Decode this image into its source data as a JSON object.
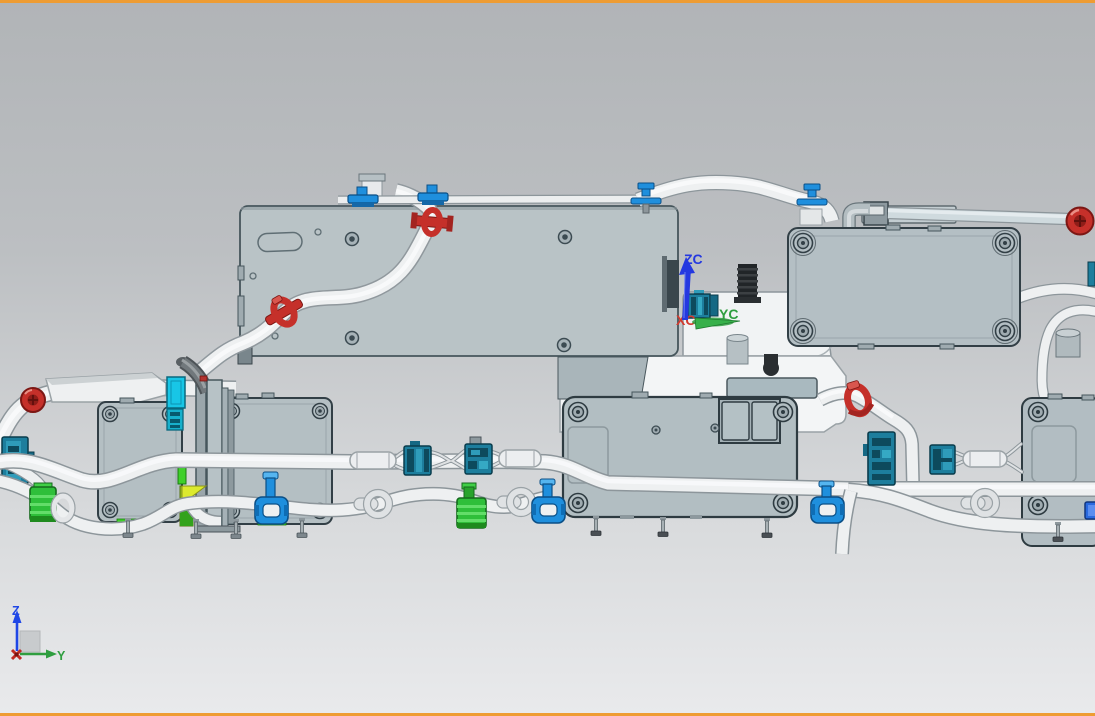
{
  "viewport": {
    "width": 1095,
    "height": 716,
    "background_top": "#b1b4b7",
    "background_bottom": "#e9eaec",
    "frame_color": "#ee9c33"
  },
  "wcs_marker": {
    "z_label": "ZC",
    "y_label": "YC",
    "x_label": "XC",
    "z_color": "#2438e0",
    "y_color": "#2f9e3f",
    "x_color": "#d23a2e"
  },
  "view_triad": {
    "z_label": "Z",
    "y_label": "Y",
    "z_color": "#1f47e6",
    "y_color": "#2f9e3f",
    "origin_color": "#c02a24"
  },
  "palette": {
    "module_fill": "#b4bfc4",
    "module_outline": "#323f46",
    "tube_fill": "#eef0f1",
    "tube_outline": "#8d969b",
    "coolant_tube": "#cfdade",
    "clamp_red": "#c5302a",
    "clip_blue": "#1f8fdd",
    "connector_teal": "#1d7e9d",
    "connector_green": "#2fbf3a",
    "accent_cyan": "#18c6e6",
    "accent_yellow": "#dcea2e",
    "antenna_black": "#212528"
  },
  "components": [
    "mounting-plate",
    "ecu-module-top-right",
    "ecu-module-center",
    "ecu-module-left-a",
    "ecu-module-left-b",
    "ecu-module-right-partial",
    "center-housing",
    "wire-harness-tubes",
    "coolant-line",
    "hose-clamps-red",
    "push-clips-blue",
    "tube-clamps-blue",
    "connectors-teal",
    "connectors-green",
    "antenna-mast",
    "work-coordinate-system",
    "view-triad"
  ]
}
